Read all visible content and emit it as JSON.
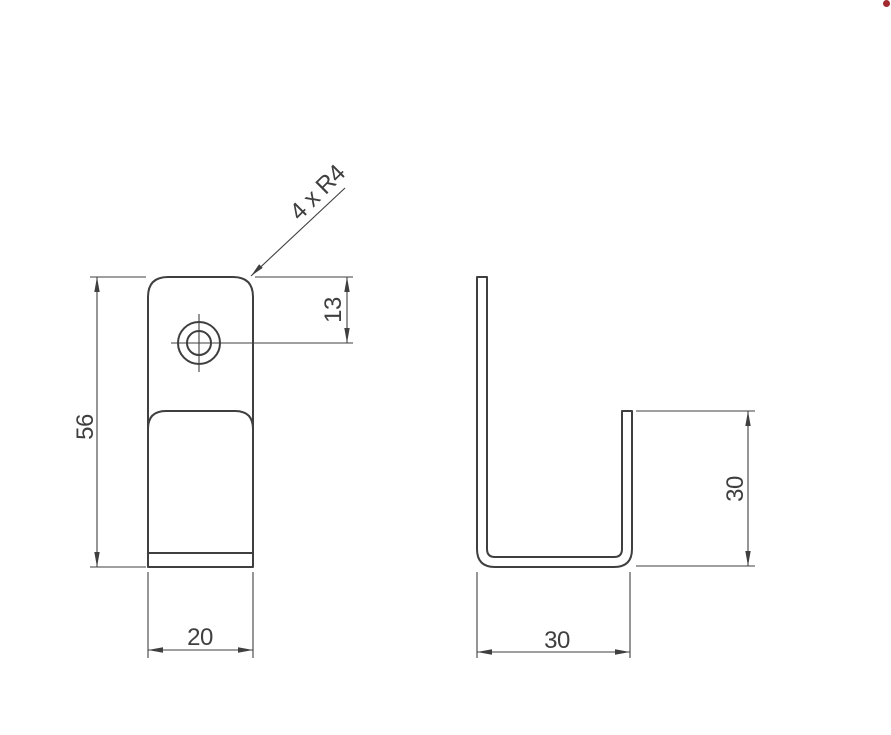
{
  "colors": {
    "line": "#3f3f3f",
    "background": "#ffffff",
    "marker_dot": "#a12a30"
  },
  "drawing": {
    "views": {
      "front": {
        "labels": {
          "height": "56",
          "width": "20",
          "hole_offset": "13",
          "corner_radius_note": "4 x R4"
        }
      },
      "side": {
        "labels": {
          "width": "30",
          "leg_height": "30"
        }
      }
    }
  }
}
